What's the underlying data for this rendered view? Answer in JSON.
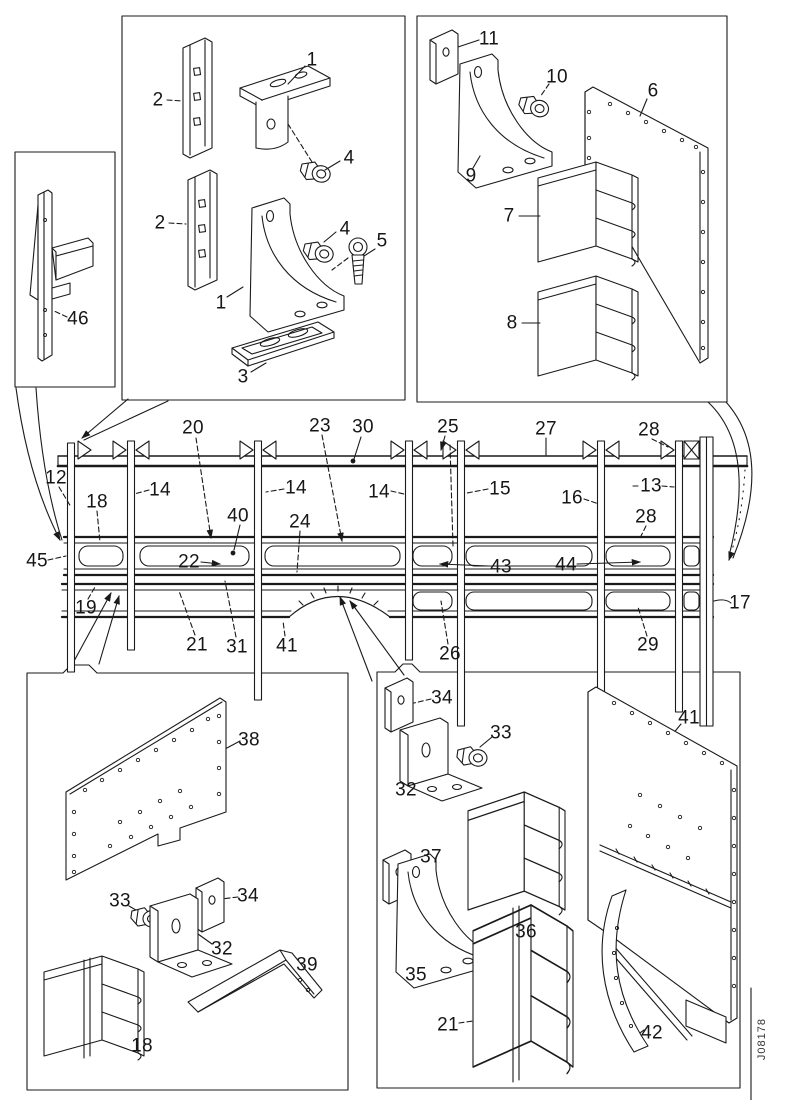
{
  "drawing_number": "J08178",
  "style": {
    "background": "#ffffff",
    "line_color": "#1a1a1a",
    "label_color": "#161616"
  },
  "callouts": {
    "tl_1_top": "1",
    "tl_2_top": "2",
    "tl_4_top": "4",
    "tl_2_bot": "2",
    "tl_4_bot": "4",
    "tl_5": "5",
    "tl_1_bot": "1",
    "tl_3": "3",
    "tr_11": "11",
    "tr_10": "10",
    "tr_6": "6",
    "tr_9": "9",
    "tr_7": "7",
    "tr_8": "8",
    "lb_46": "46",
    "m_20": "20",
    "m_23": "23",
    "m_30": "30",
    "m_25": "25",
    "m_27": "27",
    "m_28_top": "28",
    "m_12": "12",
    "m_18": "18",
    "m_14_a": "14",
    "m_14_b": "14",
    "m_14_c": "14",
    "m_15": "15",
    "m_16": "16",
    "m_13": "13",
    "m_28_mid": "28",
    "m_45": "45",
    "m_22": "22",
    "m_40": "40",
    "m_24": "24",
    "m_43": "43",
    "m_44": "44",
    "m_19": "19",
    "m_21": "21",
    "m_31": "31",
    "m_41": "41",
    "m_26": "26",
    "m_29": "29",
    "m_17": "17",
    "bl_38": "38",
    "bl_33": "33",
    "bl_34": "34",
    "bl_32": "32",
    "bl_39": "39",
    "bl_18": "18",
    "br_34": "34",
    "br_33": "33",
    "br_32": "32",
    "br_41": "41",
    "br_37": "37",
    "br_36": "36",
    "br_35": "35",
    "br_21": "21",
    "br_42": "42"
  }
}
